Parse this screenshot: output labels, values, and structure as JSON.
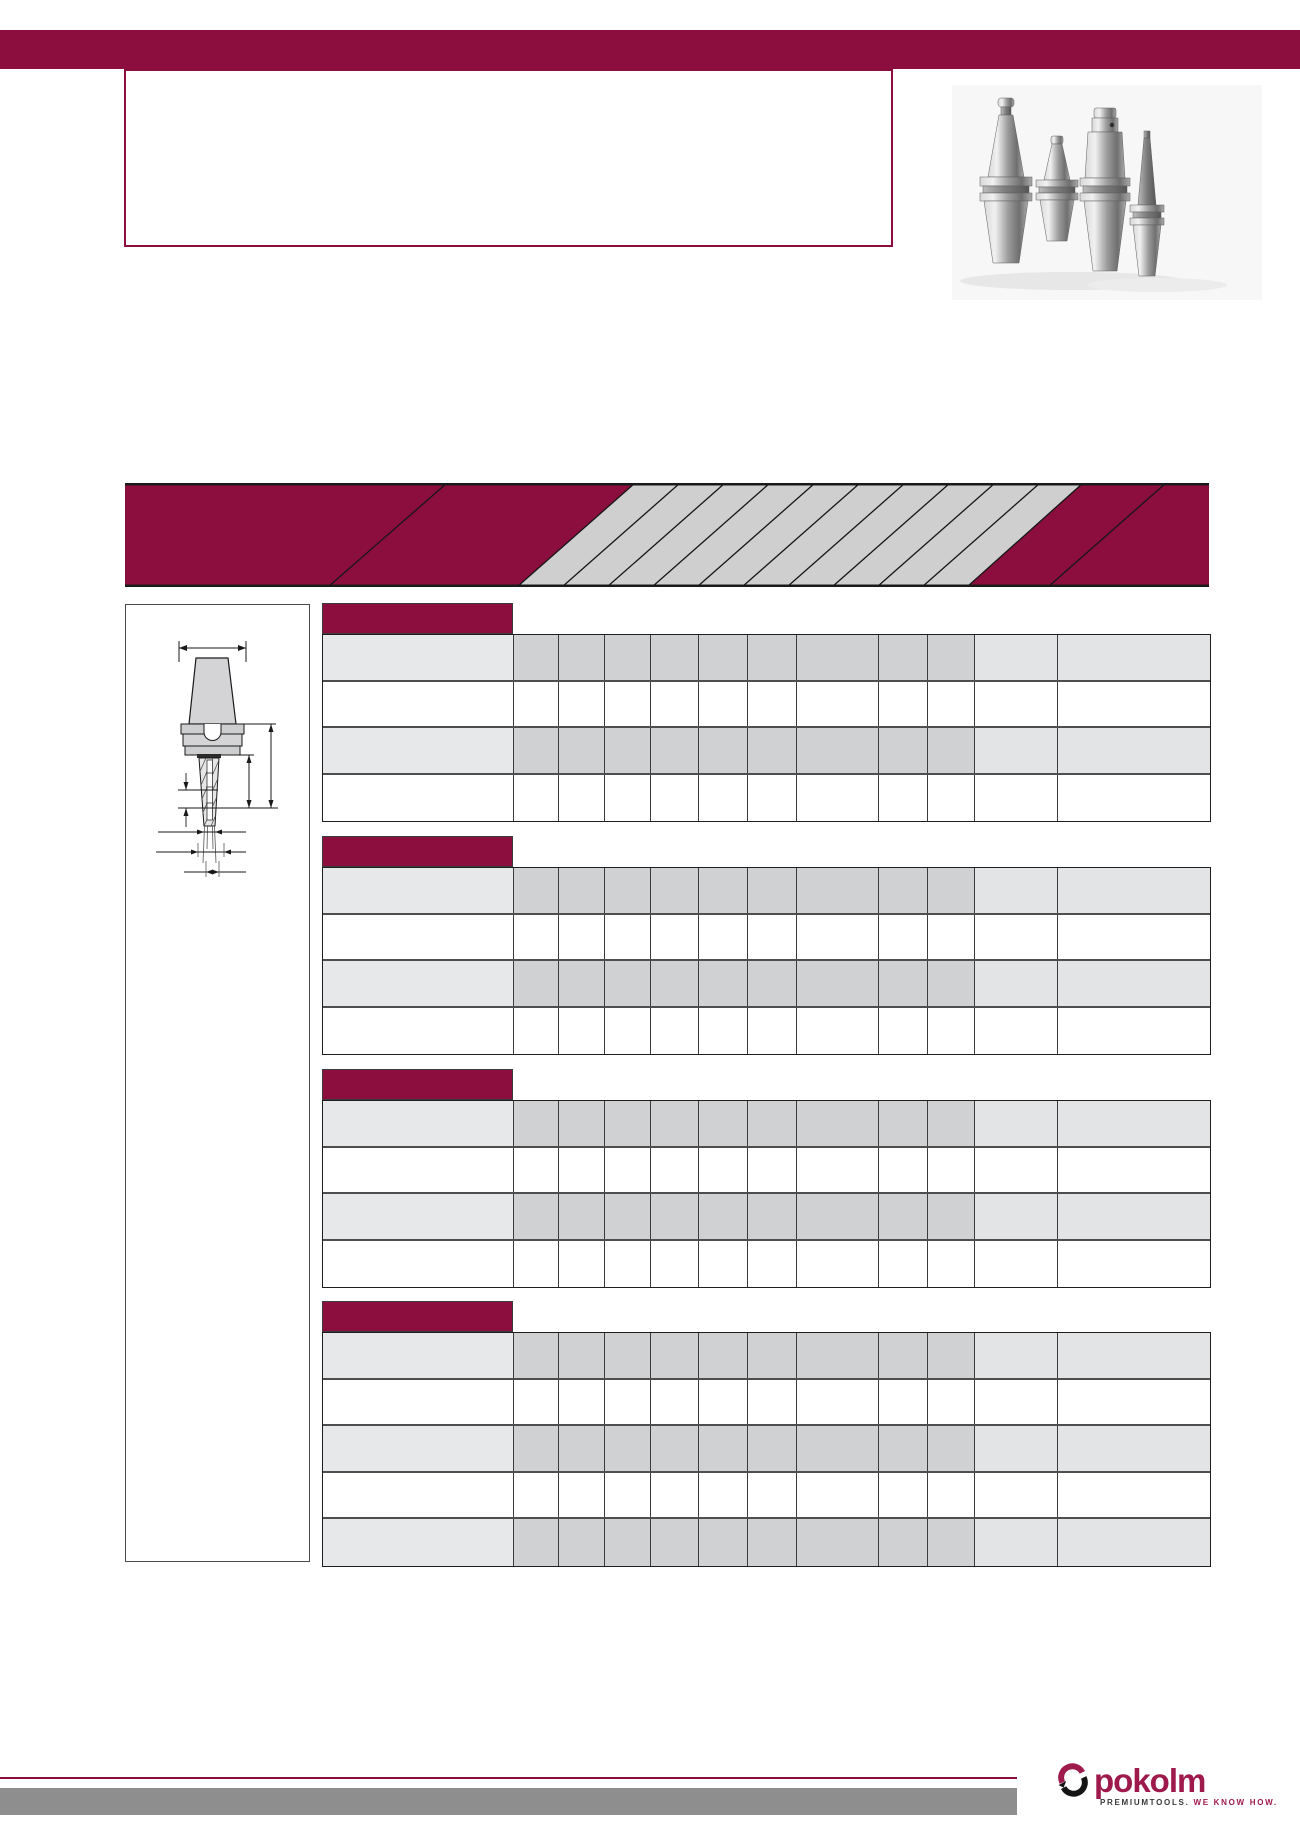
{
  "page": {
    "width": 1300,
    "height": 1839
  },
  "palette": {
    "accent": "#8c0e3e",
    "logo_maroon": "#9e1a4d",
    "banner_stripe_fill": "#cfcfcf",
    "banner_line": "#161616",
    "cell_label_shaded": "#e7e8ea",
    "cell_mid_shaded": "#cfd1d3",
    "cell_right_shaded": "#e2e4e6",
    "footer_bar": "#8e8e8e",
    "photo_bg": "#f7f7f7",
    "drawing_fill": "#d4d4d6"
  },
  "header": {
    "title_box_text": ""
  },
  "graphics": {
    "product_photo": "tool-holder-group-photo",
    "technical_drawing": "tool-holder-dimension-drawing",
    "banner": "diagonal-stripe-banner",
    "banner_stripe_count": 9
  },
  "tables": {
    "columns": 12,
    "all_cells_empty": true,
    "sections": [
      {
        "id": "table-1",
        "rows": 4,
        "pattern": [
          "shaded",
          "plain",
          "shaded",
          "plain"
        ]
      },
      {
        "id": "table-2",
        "rows": 4,
        "pattern": [
          "shaded",
          "plain",
          "shaded",
          "plain"
        ]
      },
      {
        "id": "table-3",
        "rows": 4,
        "pattern": [
          "shaded",
          "plain",
          "shaded",
          "plain"
        ]
      },
      {
        "id": "table-4",
        "rows": 5,
        "pattern": [
          "shaded",
          "plain",
          "shaded",
          "plain",
          "shaded"
        ]
      }
    ]
  },
  "footer": {
    "logo_text": "pokolm",
    "tagline_primary": "PREMIUMTOOLS.",
    "tagline_accent": "WE KNOW HOW."
  }
}
